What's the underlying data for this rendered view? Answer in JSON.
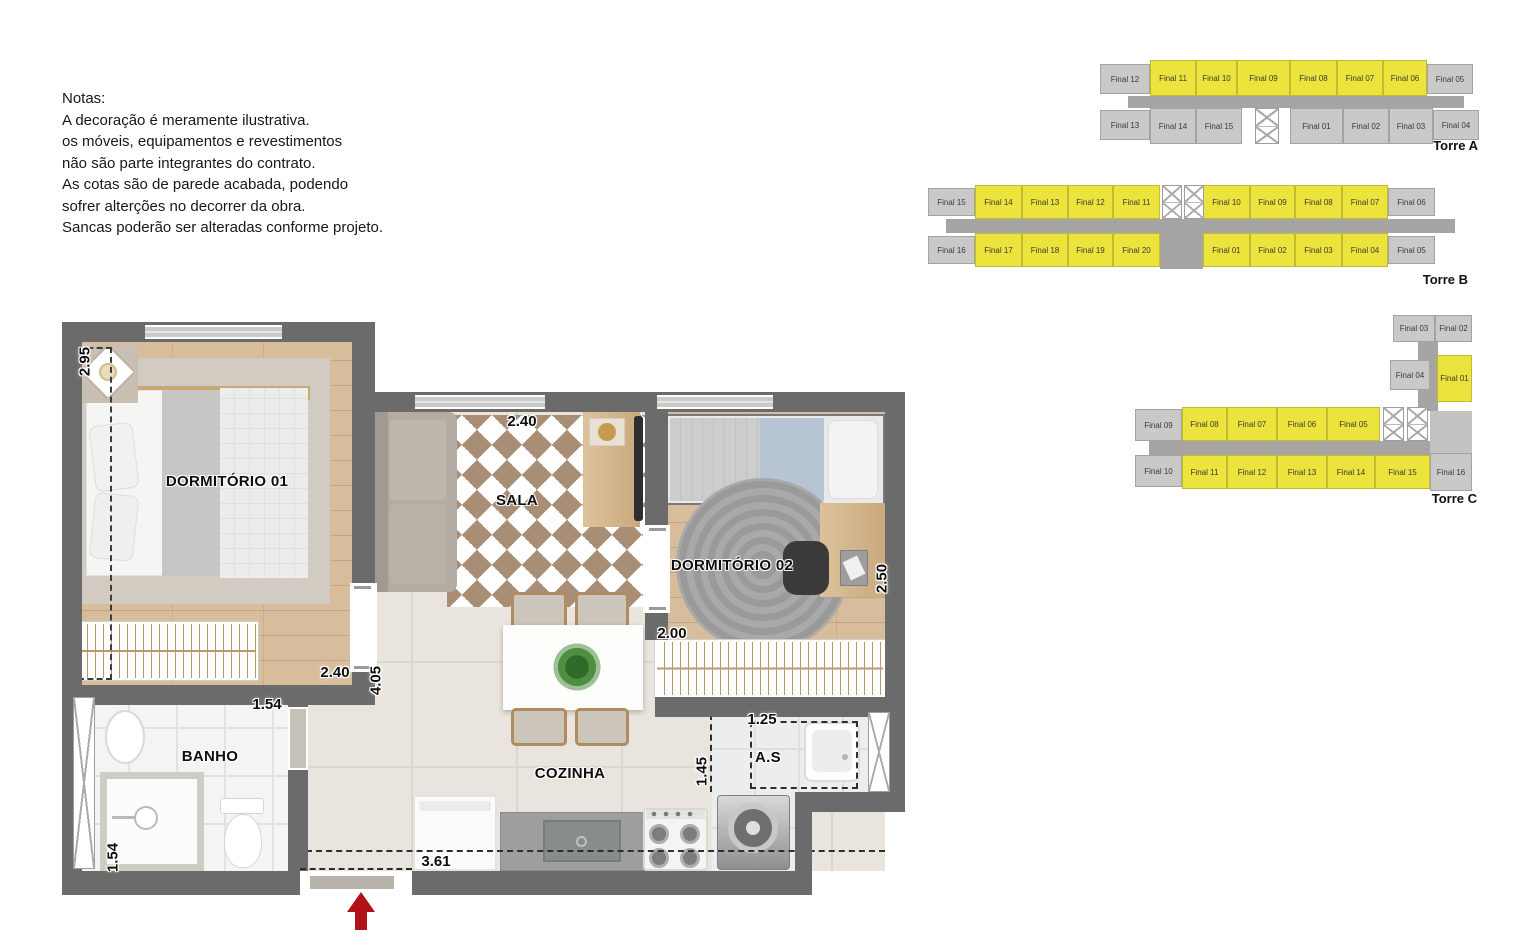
{
  "notes": {
    "title": "Notas:",
    "lines": [
      "A decoração é meramente ilustrativa.",
      "os móveis, equipamentos e revestimentos",
      "não são parte integrantes do contrato.",
      "As cotas são de parede acabada, podendo",
      "sofrer alterções no decorrer da obra.",
      "Sancas poderão ser alteradas conforme projeto."
    ]
  },
  "plan": {
    "rooms": {
      "dorm1": "DORMITÓRIO 01",
      "sala": "SALA",
      "dorm2": "DORMITÓRIO 02",
      "banho": "BANHO",
      "cozinha": "COZINHA",
      "as": "A.S"
    },
    "dims": {
      "d295": "2.95",
      "sala240": "2.40",
      "door240": "2.40",
      "v405": "4.05",
      "banho154": "1.54",
      "banho154b": "1.54",
      "w200": "2.00",
      "w250": "2.50",
      "w125": "1.25",
      "w145": "1.45",
      "w361": "3.61"
    }
  },
  "colors": {
    "highlight": "#ece33c",
    "unit_gray": "#c9c9c7",
    "corridor": "#a5a5a3",
    "wall": "#6b6b6b",
    "arrow_red": "#b11217"
  },
  "towers": [
    {
      "label": "Torre A",
      "x": 1100,
      "y": 60,
      "w": 390,
      "h": 95,
      "blocks": [
        {
          "x": 28,
          "y": 36,
          "w": 336,
          "h": 12,
          "c": "#a5a5a3"
        }
      ],
      "cells": [
        {
          "t": "Final 12",
          "x": 0,
          "y": 4,
          "w": 50,
          "h": 30,
          "hl": false
        },
        {
          "t": "Final 11",
          "x": 50,
          "y": 0,
          "w": 46,
          "h": 36,
          "hl": true
        },
        {
          "t": "Final 10",
          "x": 96,
          "y": 0,
          "w": 41,
          "h": 36,
          "hl": true
        },
        {
          "t": "Final 09",
          "x": 137,
          "y": 0,
          "w": 53,
          "h": 36,
          "hl": true
        },
        {
          "t": "Final 08",
          "x": 190,
          "y": 0,
          "w": 47,
          "h": 36,
          "hl": true
        },
        {
          "t": "Final 07",
          "x": 237,
          "y": 0,
          "w": 46,
          "h": 36,
          "hl": true
        },
        {
          "t": "Final 06",
          "x": 283,
          "y": 0,
          "w": 44,
          "h": 36,
          "hl": true
        },
        {
          "t": "Final 05",
          "x": 327,
          "y": 4,
          "w": 46,
          "h": 30,
          "hl": false
        },
        {
          "t": "Final 13",
          "x": 0,
          "y": 50,
          "w": 50,
          "h": 30,
          "hl": false
        },
        {
          "t": "Final 14",
          "x": 50,
          "y": 48,
          "w": 46,
          "h": 36,
          "hl": false
        },
        {
          "t": "Final 15",
          "x": 96,
          "y": 48,
          "w": 46,
          "h": 36,
          "hl": false
        },
        {
          "t": "Final 01",
          "x": 190,
          "y": 48,
          "w": 53,
          "h": 36,
          "hl": false
        },
        {
          "t": "Final 02",
          "x": 243,
          "y": 48,
          "w": 46,
          "h": 36,
          "hl": false
        },
        {
          "t": "Final 03",
          "x": 289,
          "y": 48,
          "w": 44,
          "h": 36,
          "hl": false
        },
        {
          "t": "Final 04",
          "x": 333,
          "y": 50,
          "w": 46,
          "h": 30,
          "hl": false
        }
      ],
      "elevators": [
        {
          "x": 155,
          "y": 48,
          "w": 24,
          "h": 36,
          "cells": 2
        }
      ],
      "label_pos": {
        "x": 318,
        "y": 78,
        "w": 60
      }
    },
    {
      "label": "Torre B",
      "x": 928,
      "y": 185,
      "w": 545,
      "h": 102,
      "blocks": [
        {
          "x": 18,
          "y": 34,
          "w": 509,
          "h": 14,
          "c": "#a5a5a3"
        },
        {
          "x": 232,
          "y": 34,
          "w": 43,
          "h": 50,
          "c": "#a5a5a3"
        }
      ],
      "cells": [
        {
          "t": "Final 15",
          "x": 0,
          "y": 3,
          "w": 47,
          "h": 28,
          "hl": false
        },
        {
          "t": "Final 14",
          "x": 47,
          "y": 0,
          "w": 47,
          "h": 34,
          "hl": true
        },
        {
          "t": "Final 13",
          "x": 94,
          "y": 0,
          "w": 46,
          "h": 34,
          "hl": true
        },
        {
          "t": "Final 12",
          "x": 140,
          "y": 0,
          "w": 45,
          "h": 34,
          "hl": true
        },
        {
          "t": "Final 11",
          "x": 185,
          "y": 0,
          "w": 47,
          "h": 34,
          "hl": true
        },
        {
          "t": "Final 10",
          "x": 275,
          "y": 0,
          "w": 47,
          "h": 34,
          "hl": true
        },
        {
          "t": "Final 09",
          "x": 322,
          "y": 0,
          "w": 45,
          "h": 34,
          "hl": true
        },
        {
          "t": "Final 08",
          "x": 367,
          "y": 0,
          "w": 47,
          "h": 34,
          "hl": true
        },
        {
          "t": "Final 07",
          "x": 414,
          "y": 0,
          "w": 46,
          "h": 34,
          "hl": true
        },
        {
          "t": "Final 06",
          "x": 460,
          "y": 3,
          "w": 47,
          "h": 28,
          "hl": false
        },
        {
          "t": "Final 16",
          "x": 0,
          "y": 51,
          "w": 47,
          "h": 28,
          "hl": false
        },
        {
          "t": "Final 17",
          "x": 47,
          "y": 48,
          "w": 47,
          "h": 34,
          "hl": true
        },
        {
          "t": "Final 18",
          "x": 94,
          "y": 48,
          "w": 46,
          "h": 34,
          "hl": true
        },
        {
          "t": "Final 19",
          "x": 140,
          "y": 48,
          "w": 45,
          "h": 34,
          "hl": true
        },
        {
          "t": "Final 20",
          "x": 185,
          "y": 48,
          "w": 47,
          "h": 34,
          "hl": true
        },
        {
          "t": "Final 01",
          "x": 275,
          "y": 48,
          "w": 47,
          "h": 34,
          "hl": true
        },
        {
          "t": "Final 02",
          "x": 322,
          "y": 48,
          "w": 45,
          "h": 34,
          "hl": true
        },
        {
          "t": "Final 03",
          "x": 367,
          "y": 48,
          "w": 47,
          "h": 34,
          "hl": true
        },
        {
          "t": "Final 04",
          "x": 414,
          "y": 48,
          "w": 46,
          "h": 34,
          "hl": true
        },
        {
          "t": "Final 05",
          "x": 460,
          "y": 51,
          "w": 47,
          "h": 28,
          "hl": false
        }
      ],
      "elevators": [
        {
          "x": 234,
          "y": 0,
          "w": 20,
          "h": 34,
          "cells": 2
        },
        {
          "x": 256,
          "y": 0,
          "w": 20,
          "h": 34,
          "cells": 2
        }
      ],
      "label_pos": {
        "x": 470,
        "y": 87,
        "w": 70
      }
    },
    {
      "label": "Torre C",
      "x": 1135,
      "y": 315,
      "w": 350,
      "h": 192,
      "blocks": [
        {
          "x": 283,
          "y": 26,
          "w": 20,
          "h": 70,
          "c": "#a5a5a3"
        },
        {
          "x": 14,
          "y": 126,
          "w": 318,
          "h": 14,
          "c": "#a5a5a3"
        },
        {
          "x": 295,
          "y": 96,
          "w": 42,
          "h": 44,
          "c": "#c2c2c0"
        }
      ],
      "cells": [
        {
          "t": "Final 03",
          "x": 258,
          "y": 0,
          "w": 42,
          "h": 27,
          "hl": false
        },
        {
          "t": "Final 02",
          "x": 300,
          "y": 0,
          "w": 37,
          "h": 27,
          "hl": false
        },
        {
          "t": "Final 04",
          "x": 255,
          "y": 45,
          "w": 40,
          "h": 30,
          "hl": false
        },
        {
          "t": "Final 01",
          "x": 302,
          "y": 40,
          "w": 35,
          "h": 47,
          "hl": true
        },
        {
          "t": "Final 09",
          "x": 0,
          "y": 94,
          "w": 47,
          "h": 32,
          "hl": false
        },
        {
          "t": "Final 08",
          "x": 47,
          "y": 92,
          "w": 45,
          "h": 34,
          "hl": true
        },
        {
          "t": "Final 07",
          "x": 92,
          "y": 92,
          "w": 50,
          "h": 34,
          "hl": true
        },
        {
          "t": "Final 06",
          "x": 142,
          "y": 92,
          "w": 50,
          "h": 34,
          "hl": true
        },
        {
          "t": "Final 05",
          "x": 192,
          "y": 92,
          "w": 53,
          "h": 34,
          "hl": true
        },
        {
          "t": "Final 10",
          "x": 0,
          "y": 140,
          "w": 47,
          "h": 32,
          "hl": false
        },
        {
          "t": "Final 11",
          "x": 47,
          "y": 140,
          "w": 45,
          "h": 34,
          "hl": true
        },
        {
          "t": "Final 12",
          "x": 92,
          "y": 140,
          "w": 50,
          "h": 34,
          "hl": true
        },
        {
          "t": "Final 13",
          "x": 142,
          "y": 140,
          "w": 50,
          "h": 34,
          "hl": true
        },
        {
          "t": "Final 14",
          "x": 192,
          "y": 140,
          "w": 48,
          "h": 34,
          "hl": true
        },
        {
          "t": "Final 15",
          "x": 240,
          "y": 140,
          "w": 55,
          "h": 34,
          "hl": true
        },
        {
          "t": "Final 16",
          "x": 295,
          "y": 138,
          "w": 42,
          "h": 38,
          "hl": false
        }
      ],
      "elevators": [
        {
          "x": 248,
          "y": 92,
          "w": 21,
          "h": 34,
          "cells": 2
        },
        {
          "x": 272,
          "y": 92,
          "w": 21,
          "h": 34,
          "cells": 2
        }
      ],
      "label_pos": {
        "x": 272,
        "y": 176,
        "w": 70
      }
    }
  ]
}
